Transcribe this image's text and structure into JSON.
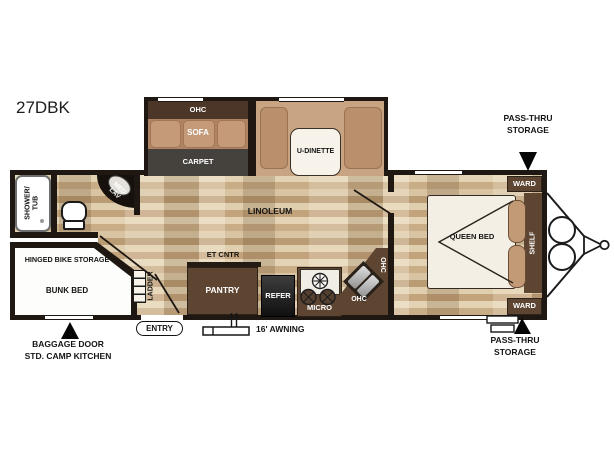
{
  "model": "27DBK",
  "slideout": {
    "ohc": "OHC",
    "sofa": "SOFA",
    "carpet": "CARPET",
    "dinette": "U-DINETTE"
  },
  "bathroom": {
    "shower_line1": "SHOWER/",
    "shower_line2": "TUB",
    "med_line1": "MED",
    "med_line2": "LAV"
  },
  "living": {
    "linoleum": "LINOLEUM",
    "et_cntr": "ET CNTR"
  },
  "kitchen": {
    "pantry": "PANTRY",
    "refer": "REFER",
    "micro": "MICRO",
    "ohc_upper": "OHC",
    "ohc_lower": "OHC"
  },
  "bedroom": {
    "queen": "QUEEN BED",
    "shelf": "SHELF",
    "ward_top": "WARD",
    "ward_bottom": "WARD"
  },
  "bunk": {
    "bike_storage": "HINGED BIKE STORAGE",
    "bed": "BUNK BED",
    "ladder": "LADDER"
  },
  "callouts": {
    "passthru_top": [
      "PASS-THRU",
      "STORAGE"
    ],
    "passthru_bottom": [
      "PASS-THRU",
      "STORAGE"
    ],
    "baggage": [
      "BAGGAGE DOOR",
      "STD. CAMP KITCHEN"
    ],
    "entry": "ENTRY",
    "awning": "16' AWNING"
  },
  "colors": {
    "wall": "#1f1812",
    "cabinet": "#5d4532",
    "ohc_band": "#4c3627",
    "carpet": "#45423e",
    "sofa": "#c49a78",
    "bench": "#c8a482",
    "floor": "#d7c2a2",
    "callout_text": "#000000"
  }
}
